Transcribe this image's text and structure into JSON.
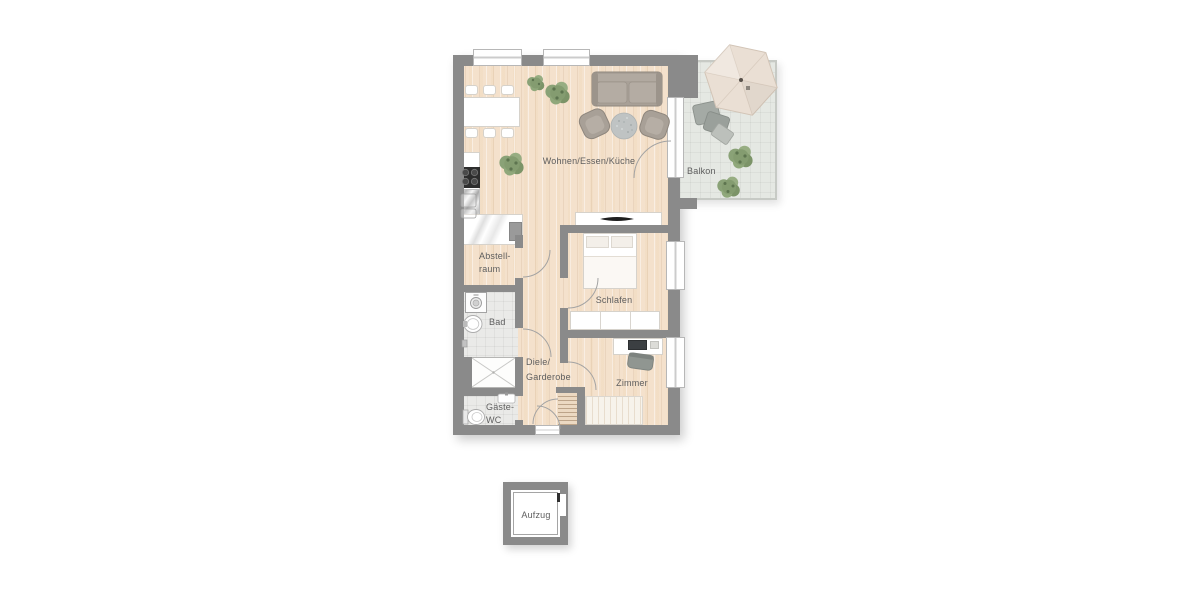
{
  "rooms": {
    "wohnen": {
      "label": "Wohnen/Essen/Küche"
    },
    "balkon": {
      "label": "Balkon"
    },
    "abstellraum": {
      "line1": "Abstell-",
      "line2": "raum"
    },
    "schlafen": {
      "label": "Schlafen"
    },
    "bad": {
      "label": "Bad"
    },
    "diele": {
      "line1": "Diele/",
      "line2": "Garderobe"
    },
    "zimmer": {
      "label": "Zimmer"
    },
    "gaeste_wc": {
      "line1": "Gäste-",
      "line2": "WC"
    },
    "aufzug": {
      "label": "Aufzug"
    }
  },
  "furniture": {
    "wohnen": [
      "dining-table",
      "six-chairs",
      "kitchen-counter",
      "stove",
      "sink",
      "sofa",
      "two-armchairs",
      "round-rug",
      "sideboard-tv",
      "plants"
    ],
    "balkon": [
      "parasol",
      "lounge-chairs",
      "plants"
    ],
    "schlafen": [
      "double-bed",
      "wardrobe"
    ],
    "zimmer": [
      "desk",
      "desk-chair",
      "single-bed"
    ],
    "bad": [
      "washing-machine",
      "washbasin",
      "shower"
    ],
    "gaeste_wc": [
      "toilet",
      "washbasin"
    ]
  },
  "colors": {
    "wall": "#8a8a8a",
    "wood_floor": "#f4e1cc",
    "tile_floor": "#eaeae8",
    "balcony_floor": "#e5e8e3",
    "sofa": "#a8a097",
    "plant_green": "#849c70",
    "umbrella": "#eadfd4",
    "label_text": "#5e5e5e"
  }
}
